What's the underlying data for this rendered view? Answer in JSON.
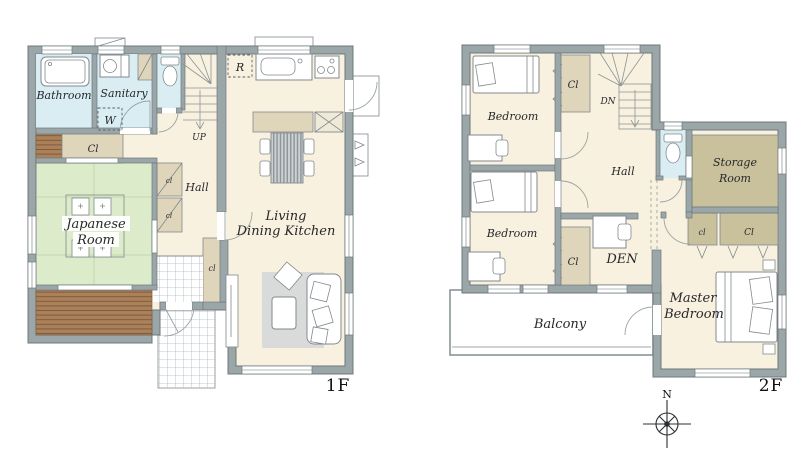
{
  "title": "house-floor-plan",
  "labels": {
    "f1": {
      "bathroom": "Bathroom",
      "sanitary": "Sanitary",
      "washer": "W",
      "hall_closet": "Cl",
      "small_closet_a": "cl",
      "small_closet_b": "cl",
      "japanese1": "Japanese",
      "japanese2": "Room",
      "hall": "Hall",
      "up": "UP",
      "fridge": "R",
      "ldk1": "Living",
      "ldk2": "Dining Kitchen",
      "entrance_closet": "cl",
      "floor": "1F"
    },
    "f2": {
      "bedroom_top": "Bedroom",
      "bedroom_bottom": "Bedroom",
      "closet_top": "Cl",
      "closet_bottom": "Cl",
      "dn": "DN",
      "hall": "Hall",
      "storage1": "Storage",
      "storage2": "Room",
      "den": "DEN",
      "master1": "Master",
      "master2": "Bedroom",
      "balcony": "Balcony",
      "closet_small": "cl",
      "closet_wide": "Cl",
      "floor": "2F"
    },
    "compass_n": "N"
  },
  "colors": {
    "wall": "#9ba6a9",
    "wall_line": "#6d787b",
    "floor": "#f9f1df",
    "tatami": "#dcebc9",
    "water": "#d9edf3",
    "closet": "#ded5bb",
    "storage": "#c9c19c",
    "deck": "#ab8159",
    "deck_line": "#7d5a3f",
    "rug": "#d9dbdb",
    "tile_line": "#aab9bb",
    "ink": "#26282a",
    "line": "#82898c"
  }
}
